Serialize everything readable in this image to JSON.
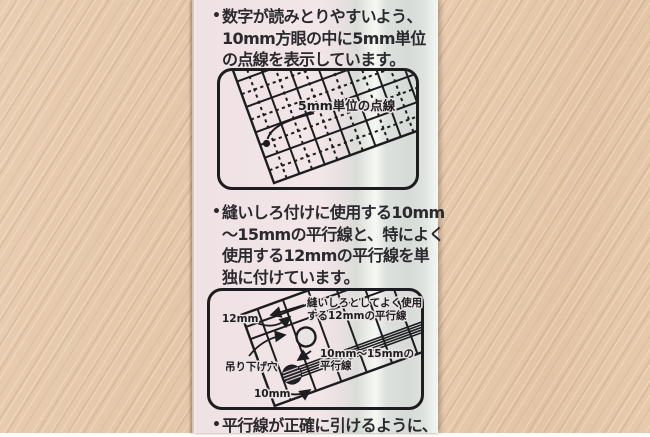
{
  "package": {
    "bullet_char": "•",
    "sections": [
      {
        "lines": [
          "数字が読みとりやすいよう、",
          "10mm方眼の中に5mm単位",
          "の点線を表示しています。"
        ]
      },
      {
        "lines": [
          "縫いしろ付けに使用する10mm",
          "〜15mmの平行線と、特によく",
          "使用する12mmの平行線を単",
          "独に付けています。"
        ]
      },
      {
        "lines": [
          "平行線が正確に引けるように、"
        ]
      }
    ],
    "diagram1": {
      "dot_label": "5mm単位の点線"
    },
    "diagram2": {
      "left_width_label": "12mm",
      "seam_label_line1": "縫いしろとしてよく使用",
      "seam_label_line2": "する12mmの平行線",
      "hole_label": "吊り下げ穴",
      "range_label_line1": "10mm〜15mmの",
      "range_label_line2": "平行線",
      "bottom_width_label": "10mm"
    },
    "colors": {
      "card_pink": "#f2e6e8",
      "card_gray_green": "#d6dbd7",
      "card_mint": "#aad0b6",
      "line_ink": "#1d1d20",
      "wood": "#e5c8ab"
    }
  }
}
